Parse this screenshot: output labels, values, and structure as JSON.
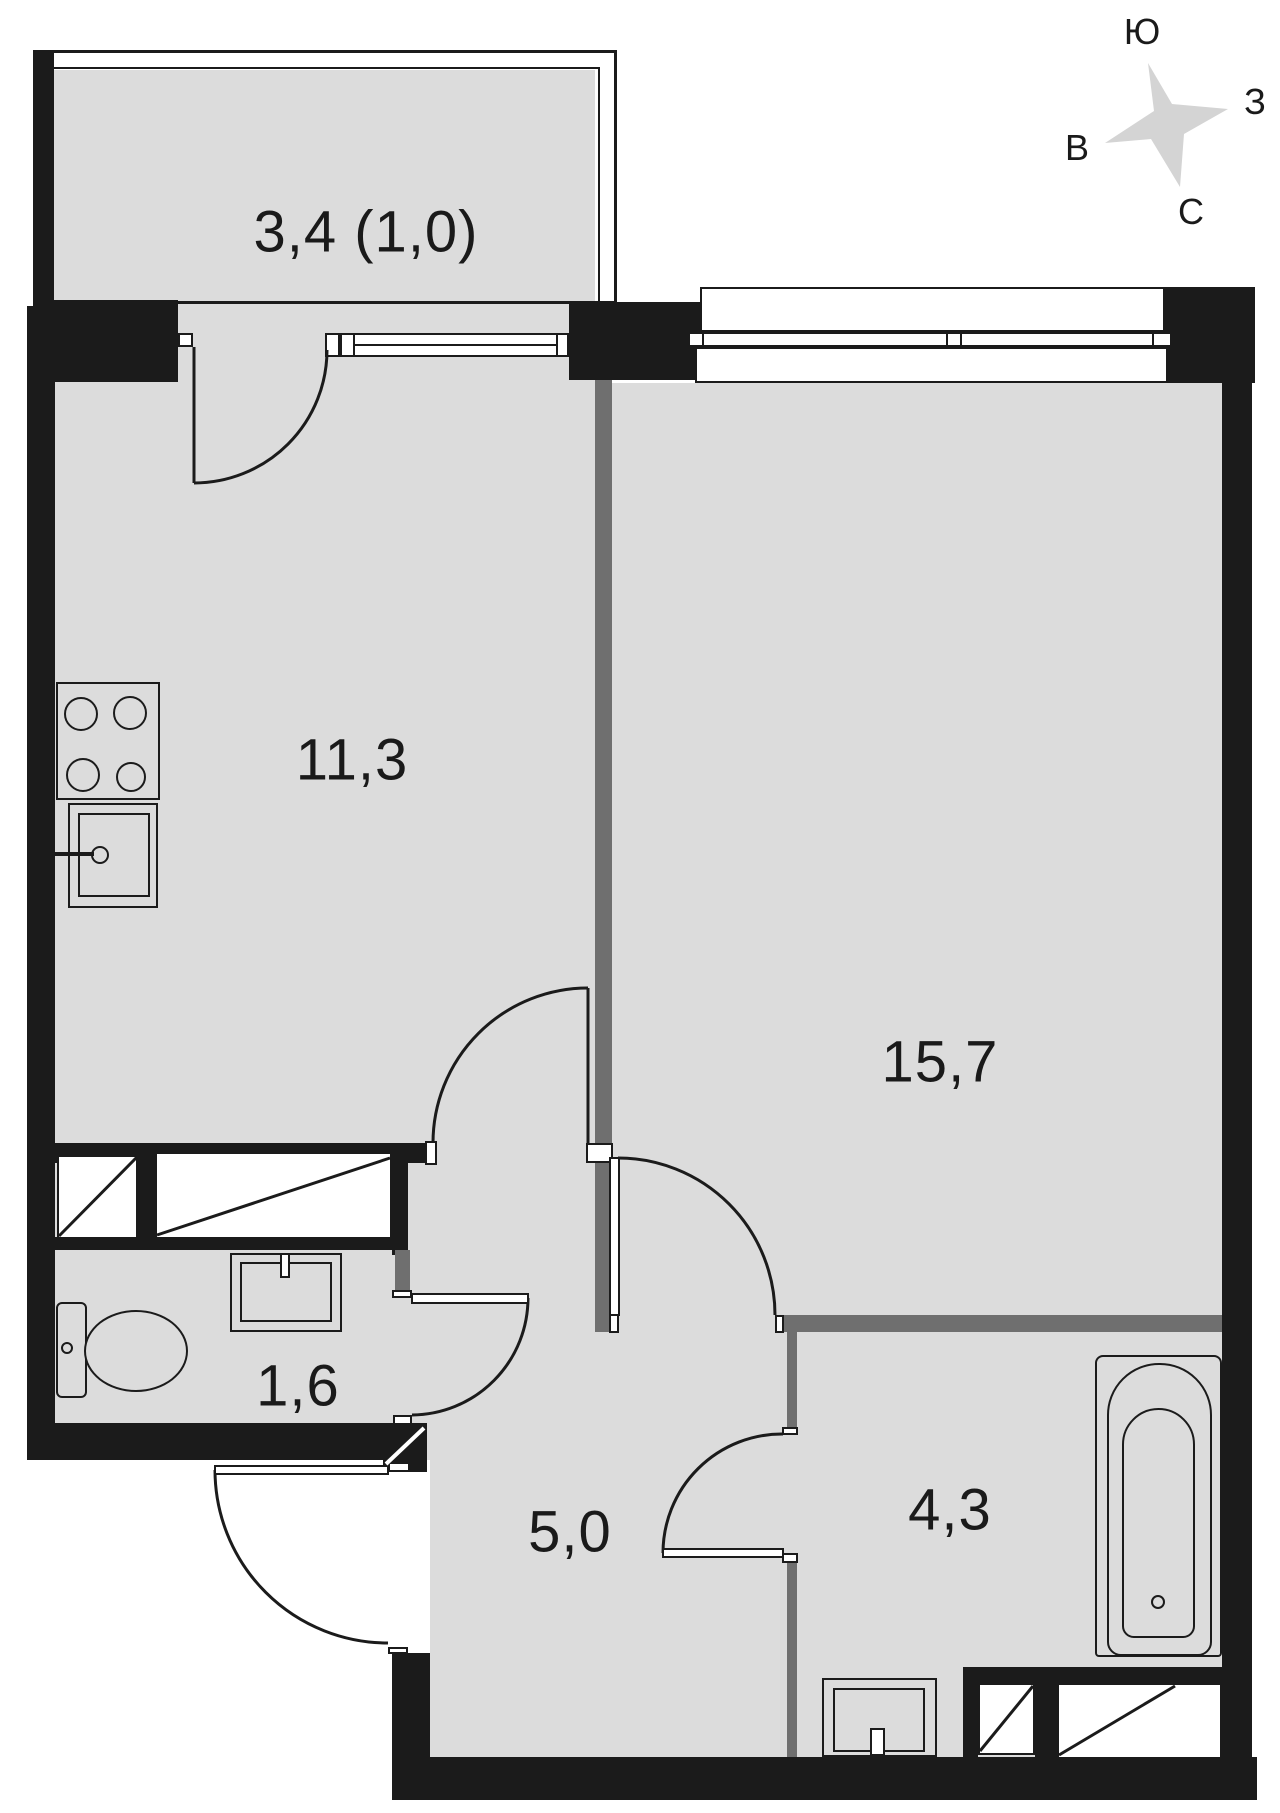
{
  "title": "apartment-floor-plan",
  "rooms": {
    "balcony": {
      "label": "3,4 (1,0)"
    },
    "kitchen": {
      "label": "11,3"
    },
    "living": {
      "label": "15,7"
    },
    "toilet": {
      "label": "1,6"
    },
    "hallway": {
      "label": "5,0"
    },
    "bathroom": {
      "label": "4,3"
    }
  },
  "compass": {
    "top": "Ю",
    "right": "З",
    "left": "В",
    "bottom": "С"
  },
  "colors": {
    "wall": "#1b1b1b",
    "partition": "#6f6f6f",
    "floor": "#dcdcdc",
    "star": "#d4d4d4",
    "text": "#1a1a1a",
    "background": "#ffffff"
  }
}
